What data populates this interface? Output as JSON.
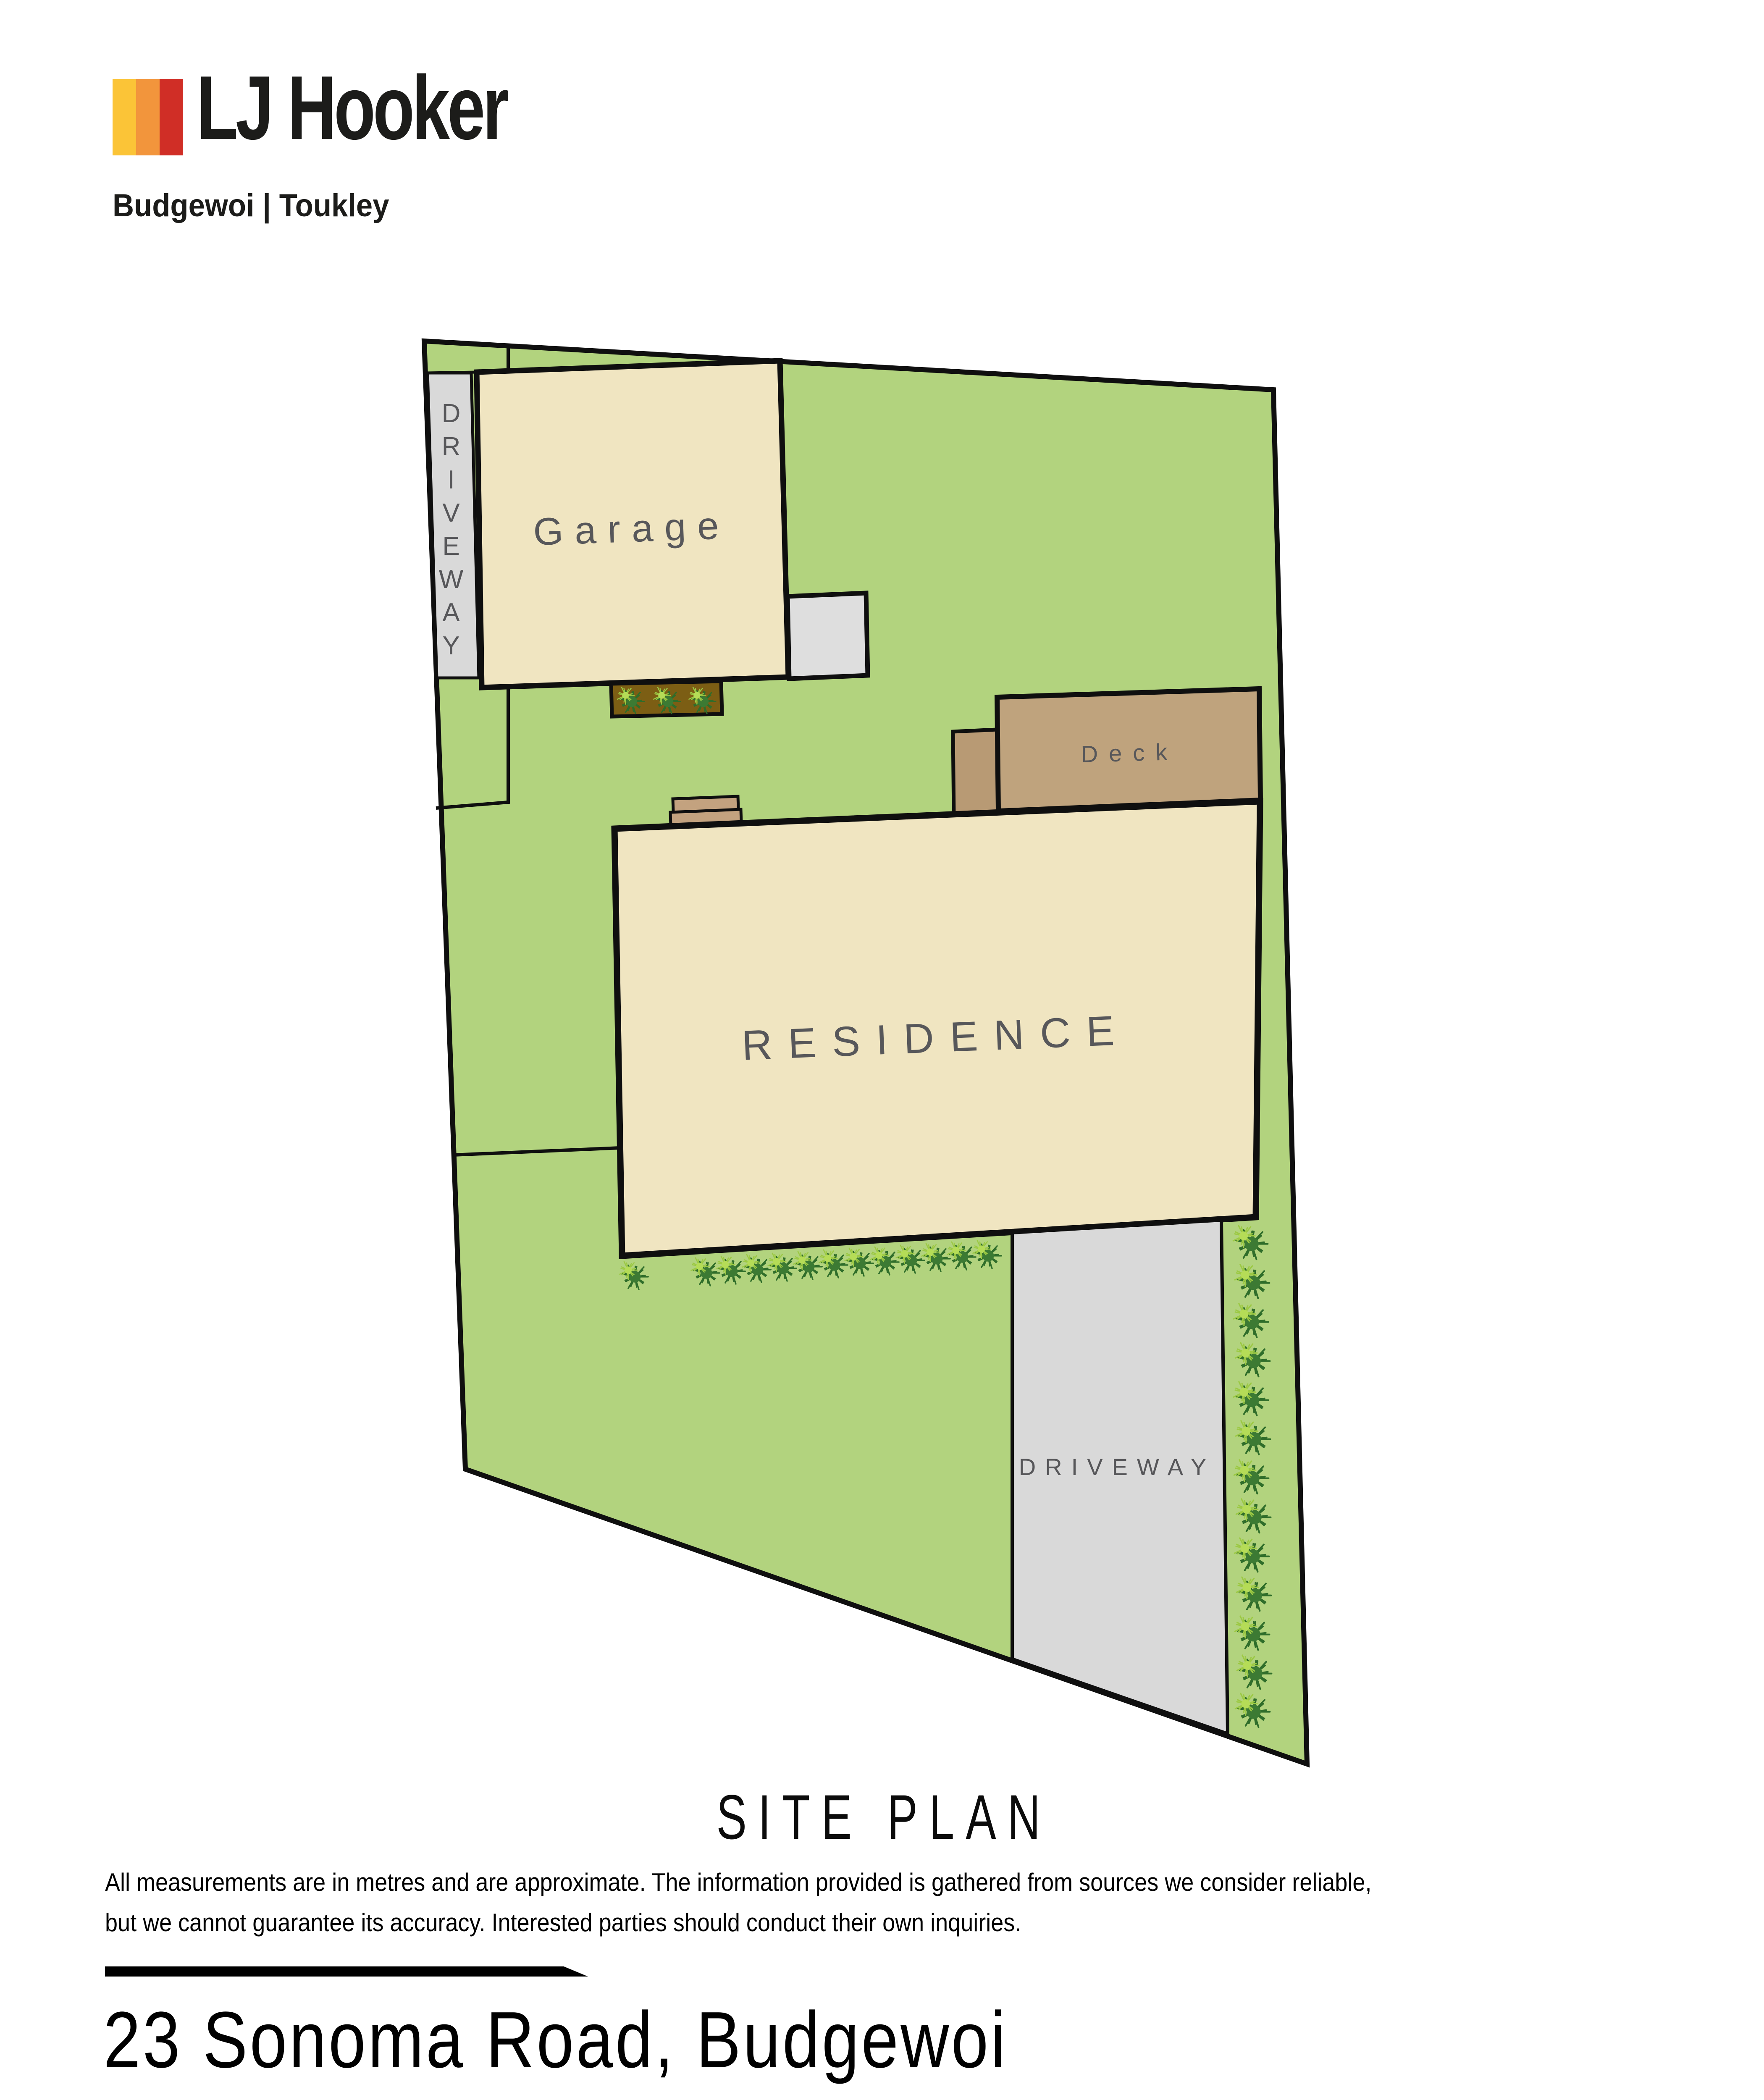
{
  "logo": {
    "brand": "LJ Hooker",
    "office": "Budgewoi | Toukley",
    "bar_colors": {
      "yellow": "#fbc437",
      "orange": "#f2953c",
      "red": "#d02e26"
    }
  },
  "site_plan": {
    "title": "SITE PLAN",
    "labels": {
      "garage": "Garage",
      "deck": "Deck",
      "residence": "RESIDENCE",
      "driveway_top": "DRIVEWAY",
      "driveway_bottom": "DRIVEWAY"
    },
    "colors": {
      "grass": "#b2d37e",
      "building": "#f0e5c1",
      "deck": "#bfa37d",
      "deck_strip": "#b89a74",
      "driveway": "#d9d9d9",
      "patio": "#dedede",
      "garden_bed": "#7c5e14",
      "outline": "#0f0f0f",
      "label": "#57575a"
    }
  },
  "footer": {
    "disclaimer_line1": "All measurements are in metres and are approximate. The information provided is gathered from sources we consider reliable,",
    "disclaimer_line2": "but we cannot guarantee its accuracy. Interested parties should conduct their own inquiries.",
    "address": "23 Sonoma Road, Budgewoi"
  }
}
